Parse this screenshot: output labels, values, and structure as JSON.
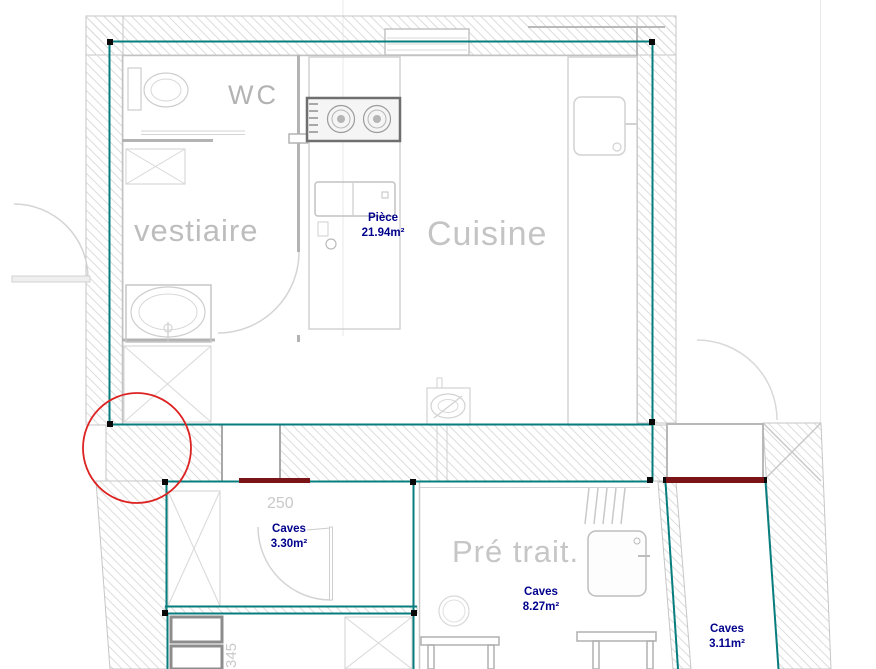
{
  "plan": {
    "title": "floor-plan-view",
    "rooms": [
      {
        "id": "wc",
        "label": "WC"
      },
      {
        "id": "vestiaire",
        "label": "vestiaire"
      },
      {
        "id": "cuisine",
        "label": "Cuisine"
      },
      {
        "id": "pre-trait",
        "label": "Pré trait."
      }
    ],
    "areas": [
      {
        "id": "piece",
        "name": "Pièce",
        "area": "21.94m²"
      },
      {
        "id": "caves-330",
        "name": "Caves",
        "area": "3.30m²"
      },
      {
        "id": "caves-827",
        "name": "Caves",
        "area": "8.27m²"
      },
      {
        "id": "caves-311",
        "name": "Caves",
        "area": "3.11m²"
      }
    ],
    "dimensions": [
      {
        "id": "dim-250",
        "value": "250"
      },
      {
        "id": "dim-345",
        "value": "345"
      }
    ],
    "colors": {
      "selection_teal": "#077d7d",
      "area_text_navy": "#00008b",
      "opening_maroon": "#7a1416",
      "revision_circle_red": "#dd2222",
      "wall_hatch_gray": "#dcdcdc"
    }
  }
}
